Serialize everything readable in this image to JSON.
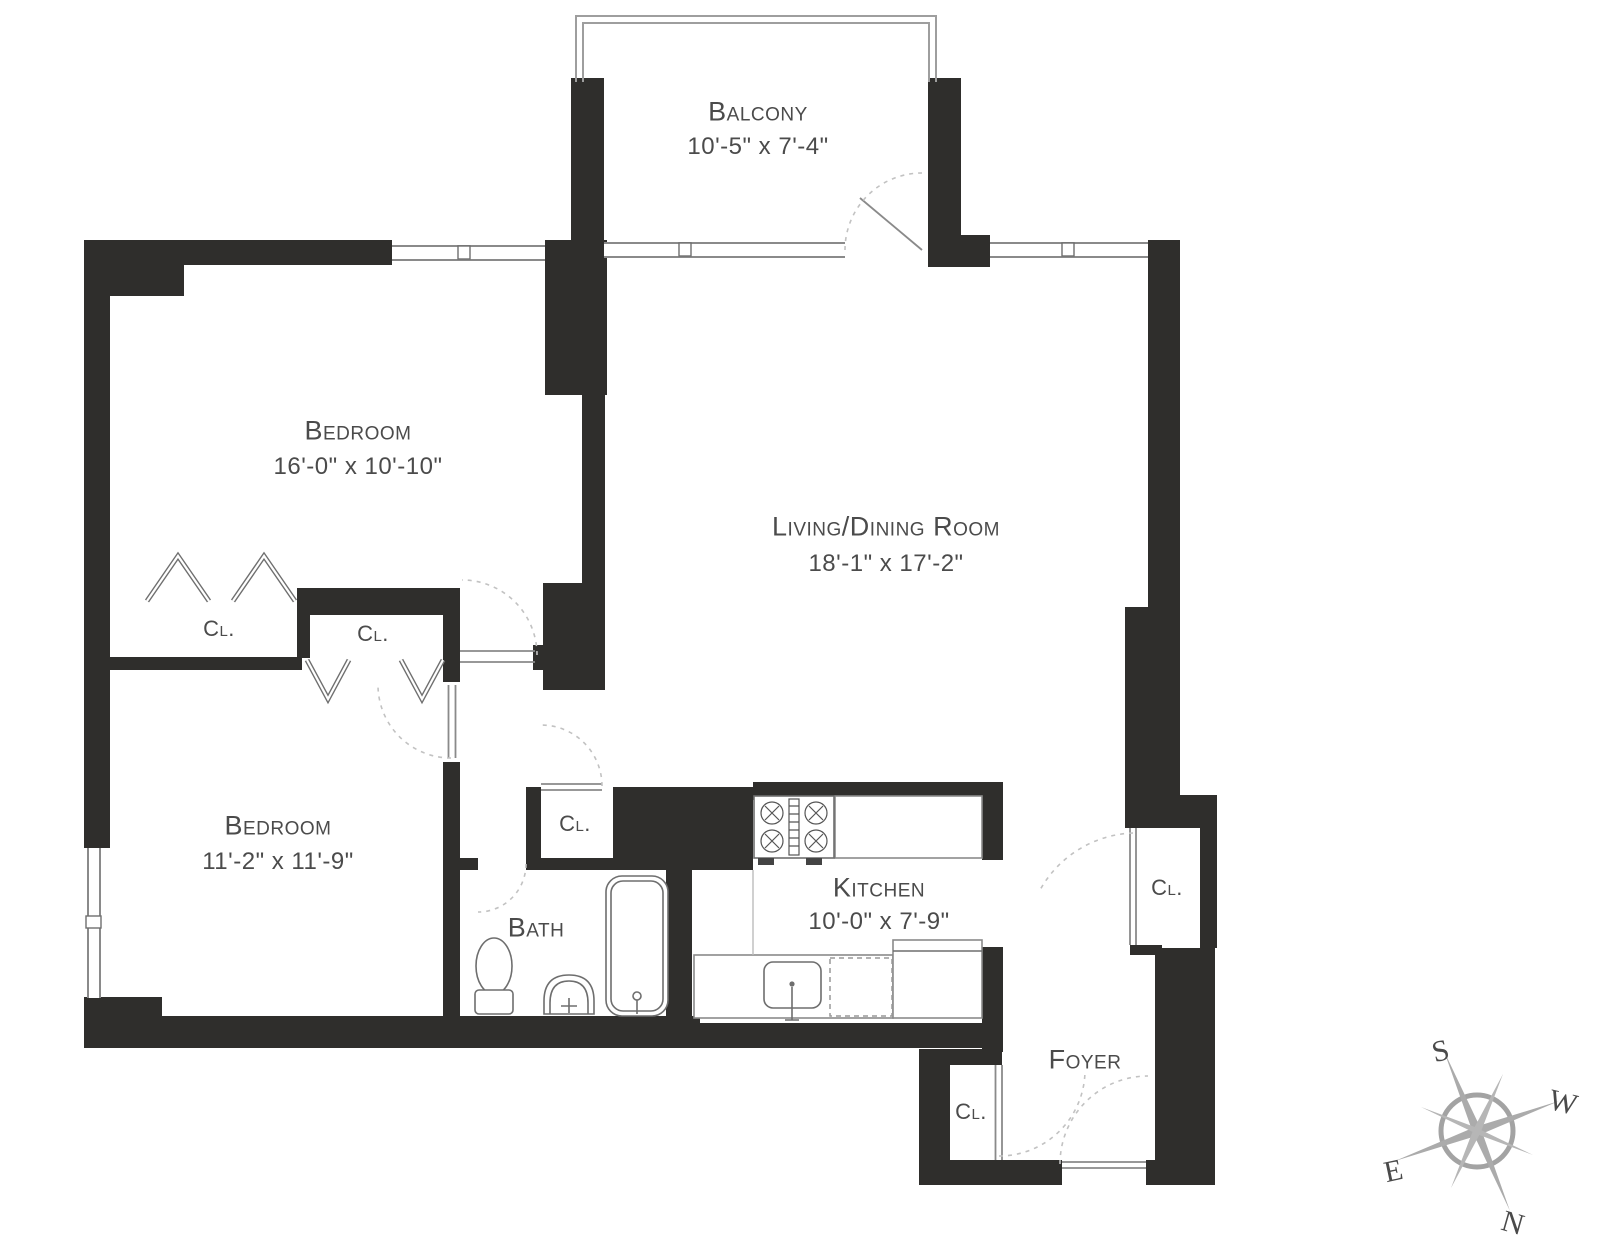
{
  "title": "Apartment floor plan",
  "colors": {
    "wall": "#2f2e2c",
    "line": "#8a8a8a",
    "label": "#4b4b4b",
    "door_swing_dash": "#c2c2c2",
    "compass": "#a3a3a3"
  },
  "rooms": {
    "balcony": {
      "name": "Balcony",
      "dims": "10'-5\" x 7'-4\""
    },
    "bedroom1": {
      "name": "Bedroom",
      "dims": "16'-0\" x 10'-10\""
    },
    "living": {
      "name": "Living/Dining Room",
      "dims": "18'-1\" x 17'-2\""
    },
    "bedroom2": {
      "name": "Bedroom",
      "dims": "11'-2\" x 11'-9\""
    },
    "bath": {
      "name": "Bath"
    },
    "kitchen": {
      "name": "Kitchen",
      "dims": "10'-0\" x 7'-9\""
    },
    "foyer": {
      "name": "Foyer"
    }
  },
  "closets": {
    "label": "Cl."
  },
  "compass": {
    "north": "N",
    "south": "S",
    "east": "E",
    "west": "W"
  }
}
